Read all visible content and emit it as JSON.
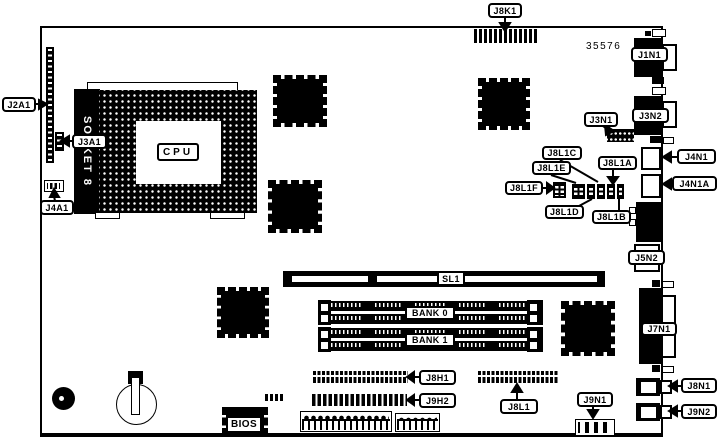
{
  "diagram": {
    "board_number": "35576",
    "cpu_label": "CPU",
    "socket_label": "SOCKET 8",
    "bios_label": "BIOS",
    "colors": {
      "line": "#000000",
      "background": "#ffffff",
      "fill": "#000000"
    }
  },
  "labels": {
    "j8k1": "J8K1",
    "j2a1": "J2A1",
    "j3a1": "J3A1",
    "j4a1": "J4A1",
    "j3n1": "J3N1",
    "j1n1": "J1N1",
    "j3n2": "J3N2",
    "j4n1": "J4N1",
    "j4n1a": "J4N1A",
    "j5n2": "J5N2",
    "j8l1c": "J8L1C",
    "j8l1e": "J8L1E",
    "j8l1f": "J8L1F",
    "j8l1d": "J8L1D",
    "j8l1a": "J8L1A",
    "j8l1b": "J8L1B",
    "sl1": "SL1",
    "bank0": "BANK 0",
    "bank1": "BANK 1",
    "j7n1": "J7N1",
    "j8h1": "J8H1",
    "j9h2": "J9H2",
    "j8l1": "J8L1",
    "j8n1": "J8N1",
    "j9n2": "J9N2",
    "j9n1": "J9N1"
  }
}
